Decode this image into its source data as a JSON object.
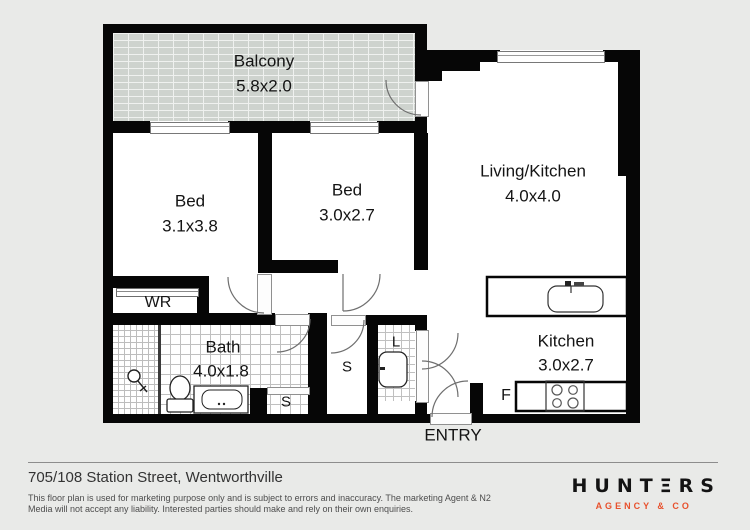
{
  "plan": {
    "balcony": {
      "name": "Balcony",
      "dims": "5.8x2.0"
    },
    "bed1": {
      "name": "Bed",
      "dims": "3.1x3.8"
    },
    "bed2": {
      "name": "Bed",
      "dims": "3.0x2.7"
    },
    "living": {
      "name": "Living/Kitchen",
      "dims": "4.0x4.0"
    },
    "kitchen": {
      "name": "Kitchen",
      "dims": "3.0x2.7"
    },
    "bath": {
      "name": "Bath",
      "dims": "4.0x1.8"
    },
    "wardrobe": "WR",
    "storage_hall": "S",
    "storage_small": "S",
    "laundry": "L",
    "fridge": "F",
    "entry": "ENTRY"
  },
  "footer": {
    "address": "705/108 Station Street, Wentworthville",
    "disclaimer_line1": "This floor plan is used for marketing purpose only and is subject to errors and inaccuracy. The marketing Agent & N2",
    "disclaimer_line2": "Media will not accept any liability. Interested parties should make and rely on their own enquiries."
  },
  "logo": {
    "brand": "HUNTΞRS",
    "tagline": "AGENCY & CO"
  },
  "colors": {
    "wall": "#000000",
    "balcony_brick": "#ced3ce",
    "accent": "#e8512d",
    "background": "#e9eae8"
  }
}
